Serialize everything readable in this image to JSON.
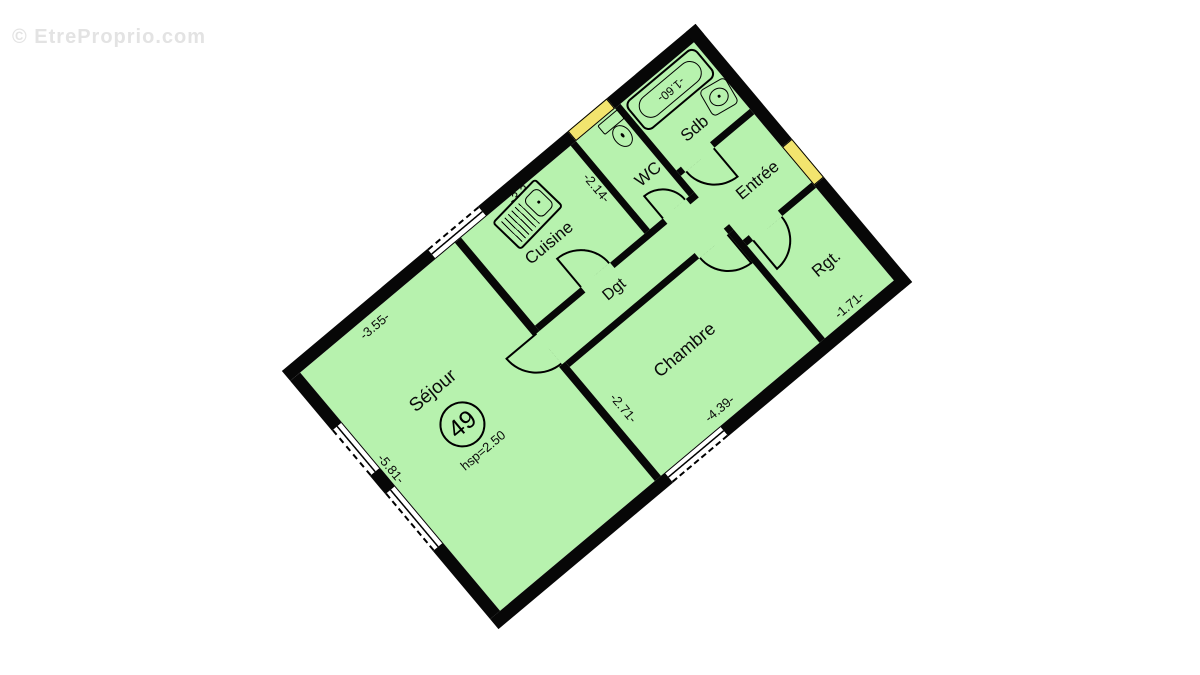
{
  "watermark": {
    "text": "© EtreProprio.com"
  },
  "plan": {
    "type": "apartment-floor-plan",
    "area_circle": "49",
    "ceiling_height": "hsp=2.50",
    "rooms": [
      {
        "name": "Séjour"
      },
      {
        "name": "Cuisine"
      },
      {
        "name": "WC"
      },
      {
        "name": "Sdb"
      },
      {
        "name": "Entrée"
      },
      {
        "name": "Rgt."
      },
      {
        "name": "Dgt"
      },
      {
        "name": "Chambre"
      }
    ],
    "dimensions": {
      "sejour_top_wall": "-3.55-",
      "sejour_left_wall": "-5.81-",
      "cuisine_wc_wall": "-2.14-",
      "cuisine_sink_wall": "-3.3-",
      "bathtub_length": "-1.60-",
      "chambre_left_wall": "-2.71-",
      "chambre_bottom_wall": "-4.39-",
      "rgt_bottom_wall": "-1.71-"
    },
    "colors": {
      "room_fill": "#b7f2ae",
      "window_yellow": "#f2e46e",
      "wall": "#070707",
      "watermark_gray": "#e3e3e3"
    }
  }
}
